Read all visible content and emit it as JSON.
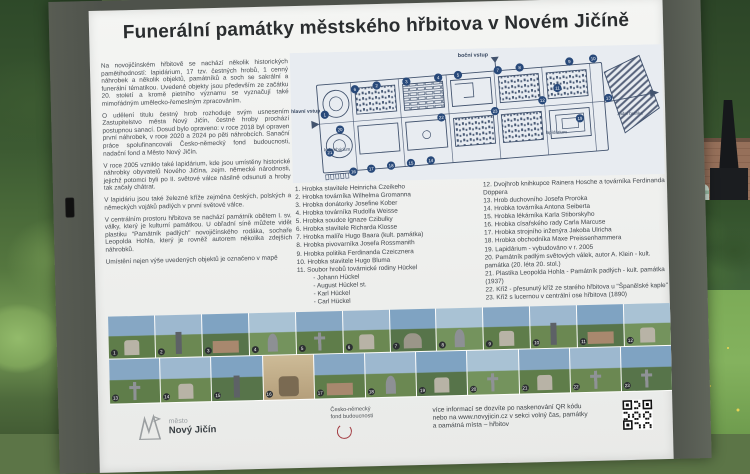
{
  "title": "Funerální památky městského hřbitova v Novém Jičíně",
  "intro": [
    "Na novojičínském hřbitově se nachází několik historických pamětihodností: lapidárium, 17 tzv. čestných hrobů, 1 cenný náhrobek a několik objektů, památníků a soch se sakrální a funerální tématikou. Uvedené objekty jsou především ze začátku 20. století a kromě pietního významu se vyznačují také mimořádným umělecko-řemeslným zpracováním.",
    "O udělení titulu čestný hrob rozhoduje svým usnesením Zastupitelstvo města Nový Jičín, čestné hroby prochází postupnou sanací. Dosud bylo opraveno: v roce 2018 byl opraven první náhrobek, v roce 2020 a 2024 po pěti náhrobcích. Sanační práce spolufinancovali Česko-německý fond budoucnosti, nadační fond a Město Nový Jičín.",
    "V roce 2005 vzniklo také lapidárium, kde jsou umístěny historické náhrobky obyvatelů Nového Jičína, zejm. německé národnosti, jejichž potomci byli po II. světové válce násilně odsunuti a hroby tak začaly chátrat.",
    "V lapidáriu jsou také železné kříže zejména českých, polských a německých vojáků padlých v první světové válce.",
    "V centrálním prostoru hřbitova se nachází památník obětem I. sv. války, který je kulturní památkou. U obřadní síně můžete vidět plastiku \"Památník padlých\" novojičínského rodáka, sochaře Leopolda Hohla, který je rovněž autorem několika zdejších náhrobků.",
    "Umístění nejen výše uvedených objektů je označeno v mapě"
  ],
  "map": {
    "labels": {
      "top_entrance": "boční vstup",
      "main_entrance": "hlavní vstup",
      "columbarium": "kolumbárium",
      "lapidarium": "lapidárium",
      "rear_gate": "zadní branka"
    },
    "marker_numbers": [
      "1",
      "2",
      "3",
      "4",
      "5",
      "6",
      "7",
      "8",
      "9",
      "10",
      "11",
      "12",
      "13",
      "14",
      "15",
      "16",
      "17",
      "18",
      "19",
      "20",
      "21",
      "22",
      "23"
    ]
  },
  "monuments_col1": [
    {
      "n": "1.",
      "text": "Hrobka stavitele Heinricha Czeikeho"
    },
    {
      "n": "2.",
      "text": "Hrobka továrníka Wilhelma Gromanna"
    },
    {
      "n": "3.",
      "text": "Hrobka donátorky Josefine Kober"
    },
    {
      "n": "4.",
      "text": "Hrobka továrníka Rudolfa Weisse"
    },
    {
      "n": "5.",
      "text": "Hrobka soudce Ignaze Czibulky"
    },
    {
      "n": "6.",
      "text": "Hrobka stavitele Richarda Klosse"
    },
    {
      "n": "7.",
      "text": "Hrobka malíře Hugo Baara (kult. památka)"
    },
    {
      "n": "8.",
      "text": "Hrobka pivovarníka Josefa Rossmanith"
    },
    {
      "n": "9.",
      "text": "Hrobka politika Ferdinanda Czeicznera"
    },
    {
      "n": "10.",
      "text": "Hrobka stavitele Hugo Bluma"
    },
    {
      "n": "11.",
      "text": "Soubor hrobů továrnické rodiny Hückel",
      "sub": [
        "- Johann Hückel",
        "- August Hückel st.",
        "- Karl Hückel",
        "- Carl Hückel"
      ]
    }
  ],
  "monuments_col2": [
    {
      "n": "12.",
      "text": "Dvojhrob knihkupce Rainera Hosche a továrníka Ferdinanda Döppera"
    },
    {
      "n": "13.",
      "text": "Hrob duchovního Josefa Proroka"
    },
    {
      "n": "14.",
      "text": "Hrobka továrníka Antona Seiberta"
    },
    {
      "n": "15.",
      "text": "Hrobka lékárníka Karla Stiborskyho"
    },
    {
      "n": "16.",
      "text": "Hrobka císařského rady Carla Marcuse"
    },
    {
      "n": "17.",
      "text": "Hrobka strojního inženýra Jakoba Ulricha"
    },
    {
      "n": "18.",
      "text": "Hrobka obchodníka Maxe Preissenhammera"
    },
    {
      "n": "19.",
      "text": "Lapidárium - vybudováno v r. 2005"
    },
    {
      "n": "20.",
      "text": "Památník padlým světových válek, autor A. Klein - kult. památka (20. léta 20. stol.)"
    },
    {
      "n": "21.",
      "text": "Plastika Leopolda Hohla - Památník padlých - kult. památka (1937)"
    },
    {
      "n": "22.",
      "text": "Kříž - přesunutý kříž ze starého hřbitova u \"Španělské kaple\""
    },
    {
      "n": "23.",
      "text": "Kříž s lucernou v centrální ose hřbitova (1890)"
    }
  ],
  "photos": {
    "row1_numbers": [
      "1",
      "2",
      "3",
      "4",
      "5",
      "6",
      "7",
      "8",
      "9",
      "10",
      "11",
      "12"
    ],
    "row2_numbers": [
      "13",
      "14",
      "15",
      "16",
      "17",
      "18",
      "19",
      "20",
      "21",
      "22",
      "23"
    ]
  },
  "footer": {
    "city_logo_small": "město",
    "city_logo_name": "Nový Jičín",
    "fund_logo_line1": "Česko-německý",
    "fund_logo_line2": "fond budoucnosti",
    "info_lines": [
      "více informací se dozvíte po naskenování QR kódu",
      "nebo na www.novyjicin.cz v sekci volný čas, památky",
      "a památná místa – hřbitov"
    ]
  },
  "colors": {
    "marker_blue": "#28497a",
    "map_ink": "#42536e",
    "fund_red": "#a23a40",
    "frame": "#4e524b"
  }
}
